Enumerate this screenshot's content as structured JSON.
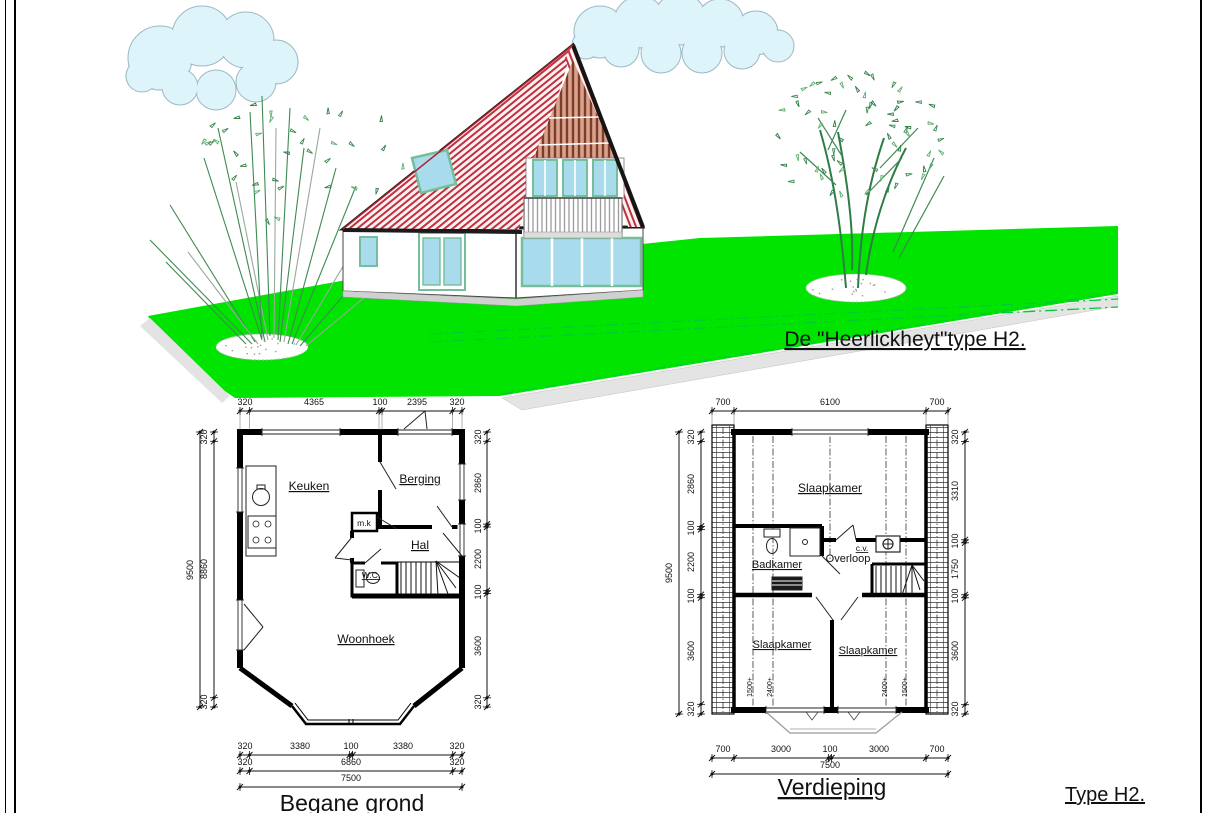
{
  "scene": {
    "title": "De \"Heerlickheyt\"type H2.",
    "type_label": "Type H2.",
    "colors": {
      "lawn": "#00e400",
      "roof_red": "#c0303f",
      "timber_brown": "#8a4a3a",
      "window_glass": "#a8dcec",
      "window_frame": "#76bd9b",
      "cloud_fill": "#def4fb",
      "boundary_green": "#00cc33"
    }
  },
  "ground": {
    "title": "Begane grond",
    "rooms": {
      "keuken": "Keuken",
      "berging": "Berging",
      "mk": "m.k",
      "hal": "Hal",
      "wc": "W.C.",
      "woonhoek": "Woonhoek"
    },
    "dims_top": [
      "320",
      "4365",
      "100",
      "2395",
      "320"
    ],
    "dim_left_outer": "9500",
    "dims_left": [
      "320",
      "8860",
      "320"
    ],
    "dims_right": [
      "320",
      "2860",
      "100",
      "2200",
      "100",
      "3600",
      "320"
    ],
    "dims_bottom1": [
      "320",
      "3380",
      "100",
      "3380",
      "320"
    ],
    "dims_bottom2": [
      "320",
      "6860",
      "320"
    ],
    "dim_bottom3": "7500"
  },
  "upper": {
    "title": "Verdieping",
    "rooms": {
      "slaapkamer_top": "Slaapkamer",
      "badkamer": "Badkamer",
      "overloop": "Overloop",
      "cv": "c.v.",
      "slaapkamer_left": "Slaapkamer",
      "slaapkamer_right": "Slaapkamer"
    },
    "knee_wall_labels": [
      "1500+",
      "2400+",
      "2400+",
      "1500+"
    ],
    "dims_top": [
      "700",
      "6100",
      "700"
    ],
    "dim_left_outer": "9500",
    "dims_left": [
      "320",
      "2860",
      "100",
      "2200",
      "100",
      "3600",
      "320"
    ],
    "dims_right": [
      "320",
      "3310",
      "100",
      "1750",
      "100",
      "3600",
      "320"
    ],
    "dims_bottom1": [
      "700",
      "3000",
      "100",
      "3000",
      "700"
    ],
    "dim_bottom2": "7500"
  }
}
